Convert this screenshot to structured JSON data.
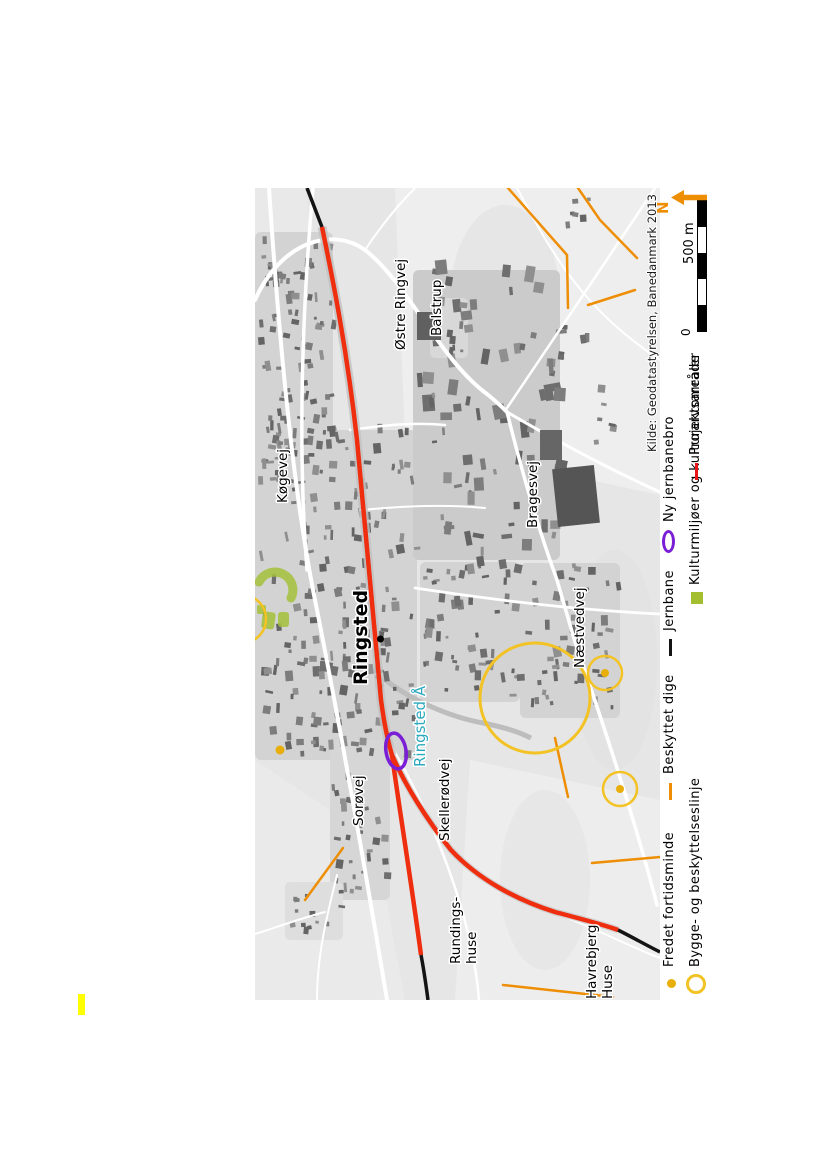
{
  "page": {
    "background": "#ffffff",
    "highlight_mark_color": "#ffff00"
  },
  "map": {
    "source_credit": "Kilde: Geodatastyrelsen, Banedanmark 2013",
    "labels": [
      {
        "text": "Østre Ringvej"
      },
      {
        "text": "Balstrup"
      },
      {
        "text": "Køgevej"
      },
      {
        "text": "Bragesvej"
      },
      {
        "text": "Næstvedvej"
      },
      {
        "text": "Sorøvej"
      },
      {
        "text": "Skellerødvej"
      },
      {
        "text": "Rundings-"
      },
      {
        "text": "huse"
      },
      {
        "text": "Havrebjerg"
      },
      {
        "text": "Huse"
      },
      {
        "text": "Ringsted Å"
      },
      {
        "text": "Ringsted"
      }
    ]
  },
  "legend": {
    "rows": [
      {
        "items": [
          {
            "symbol": "fortidsminde-dot",
            "label": "Fredet fortidsminde"
          },
          {
            "symbol": "dige-dash",
            "label": "Beskyttet dige"
          },
          {
            "symbol": "jernbane-dash",
            "label": "Jernbane"
          },
          {
            "symbol": "jernbanebro-ellipse",
            "label": "Ny jernbanebro"
          }
        ]
      },
      {
        "items": [
          {
            "symbol": "byggelinje-circle",
            "label": "Bygge- og beskyttelseslinje"
          },
          {
            "symbol": "kulturmiljo-square",
            "label": "Kulturmiljøer og kulturarvsarealer"
          },
          {
            "symbol": "projektomrade-dash",
            "label": "Projektområde"
          }
        ]
      }
    ]
  },
  "scalebar": {
    "zero_label": "0",
    "max_label": "500 m"
  },
  "north_arrow": {
    "label": "N"
  },
  "colors": {
    "projekt_red": "#ee2e0e",
    "jernbane_black": "#141414",
    "dige_orange": "#ee8e04",
    "bro_purple": "#7b1fd6",
    "byggelinje_yellow": "#f3c224",
    "fortidsminde_gold": "#e8ae09",
    "kulturmiljo_green": "#a3bf2f",
    "river_cyan": "#2aa9be",
    "north_orange": "#ee8e04"
  }
}
